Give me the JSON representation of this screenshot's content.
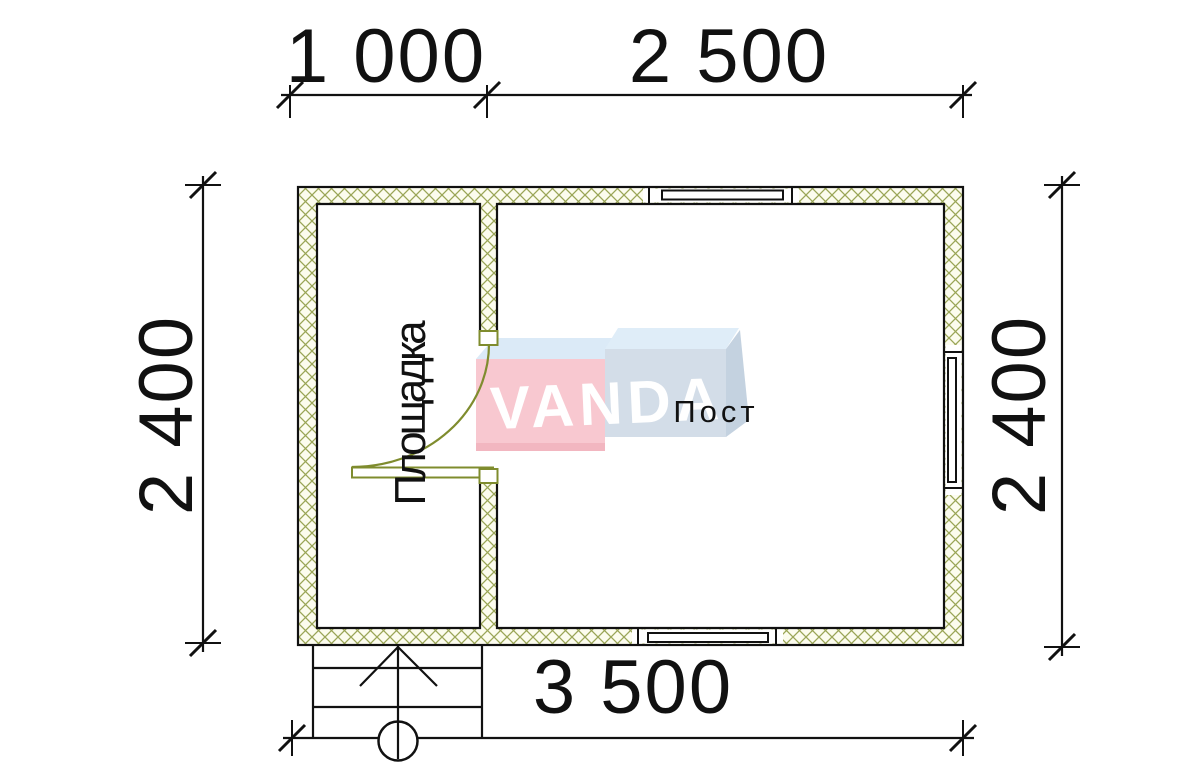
{
  "drawing": {
    "dimensions": {
      "top_left": "1 000",
      "top_right": "2 500",
      "left": "2 400",
      "right": "2 400",
      "bottom": "3 500"
    },
    "rooms": {
      "vestibule": "Площадка",
      "post": "Пост"
    },
    "logo": {
      "text": "VANDA"
    },
    "colors": {
      "line": "#111111",
      "wall_hatch": "#9aa556",
      "wall_hatch_bg": "#fcfcee",
      "door": "#7f8c2e",
      "logo_pink": "#f8c8d0",
      "logo_pink_dark": "#f2b6c0",
      "logo_pink_top": "#dbeaf7",
      "logo_blue_front": "#d3dde8",
      "logo_blue_top": "#dfedf8",
      "logo_blue_side": "#c4d2e0",
      "logo_text_color": "#ffffff"
    }
  }
}
